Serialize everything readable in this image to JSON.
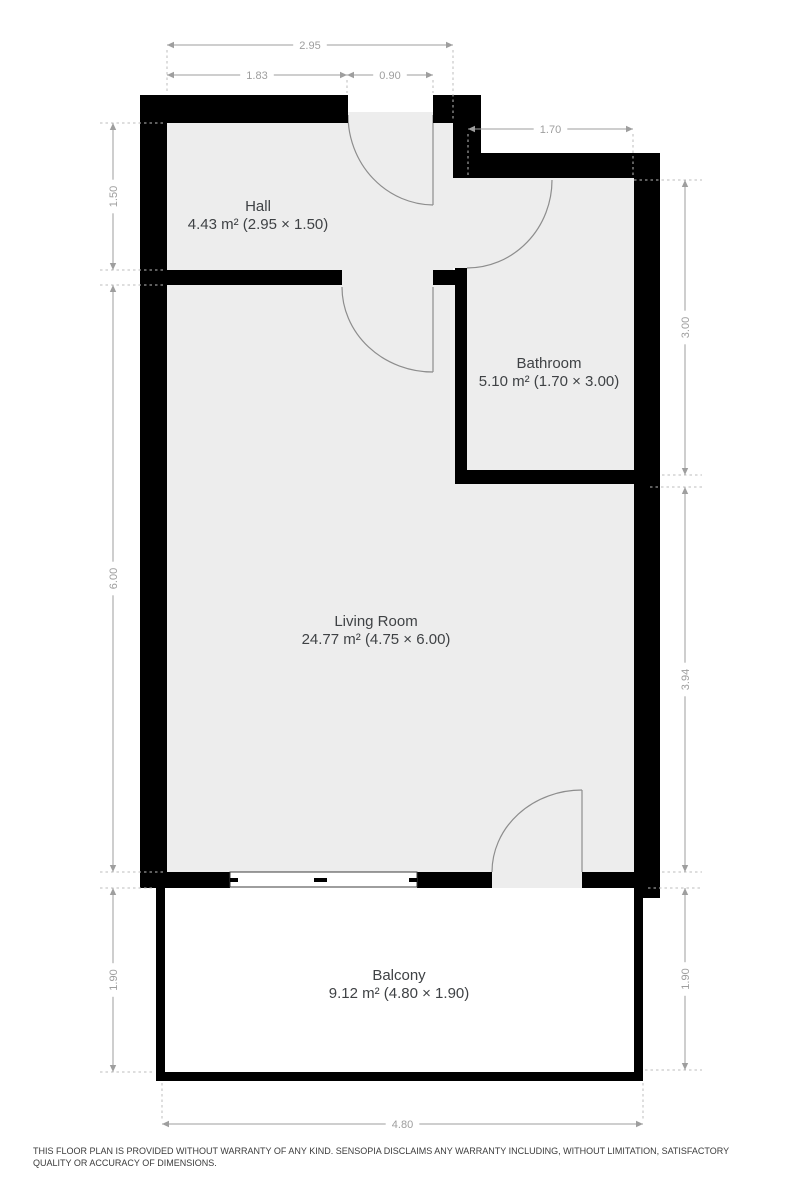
{
  "palette": {
    "wall": "#000000",
    "floor": "#ededed",
    "balcony_floor": "#ffffff",
    "dim": "#9e9e9e",
    "ext": "#bdbdbd",
    "door": "#8d8d8d",
    "window_frame": "#3c3c3c",
    "label": "#3f4245",
    "background": "#ffffff"
  },
  "floorplan": {
    "width": 800,
    "height": 1200,
    "rooms": [
      {
        "name": "Hall",
        "area": "4.43 m² (2.95 × 1.50)",
        "x": 258,
        "y": 211
      },
      {
        "name": "Bathroom",
        "area": "5.10 m² (1.70 × 3.00)",
        "x": 549,
        "y": 368
      },
      {
        "name": "Living Room",
        "area": "24.77 m² (4.75 × 6.00)",
        "x": 376,
        "y": 626
      },
      {
        "name": "Balcony",
        "area": "9.12 m² (4.80 × 1.90)",
        "x": 399,
        "y": 980
      }
    ],
    "floors": [
      {
        "n": "floor-hall",
        "x": 167,
        "y": 123,
        "w": 286,
        "h": 749
      },
      {
        "n": "floor-living-east",
        "x": 453,
        "y": 285,
        "w": 181,
        "h": 587
      },
      {
        "n": "floor-bathroom",
        "x": 467,
        "y": 178,
        "w": 167,
        "h": 292
      },
      {
        "n": "floor-bathroom-doorway",
        "x": 453,
        "y": 178,
        "w": 14,
        "h": 90
      },
      {
        "n": "floor-balcony-doorway",
        "x": 492,
        "y": 872,
        "w": 90,
        "h": 16
      },
      {
        "n": "floor-entry-threshold",
        "x": 348,
        "y": 112,
        "w": 85,
        "h": 11
      },
      {
        "n": "floor-balcony",
        "x": 165,
        "y": 888,
        "w": 469,
        "h": 184,
        "fill": "balcony"
      }
    ],
    "walls": [
      {
        "n": "wall-top-left",
        "x": 140,
        "y": 95,
        "w": 208,
        "h": 28
      },
      {
        "n": "wall-top-right",
        "x": 433,
        "y": 95,
        "w": 48,
        "h": 28
      },
      {
        "n": "wall-left",
        "x": 140,
        "y": 95,
        "w": 27,
        "h": 790
      },
      {
        "n": "wall-entry-step",
        "x": 453,
        "y": 123,
        "w": 28,
        "h": 55
      },
      {
        "n": "wall-bathroom-top",
        "x": 453,
        "y": 153,
        "w": 207,
        "h": 25
      },
      {
        "n": "wall-right",
        "x": 634,
        "y": 153,
        "w": 26,
        "h": 745
      },
      {
        "n": "wall-hall-divider",
        "x": 167,
        "y": 270,
        "w": 175,
        "h": 15
      },
      {
        "n": "wall-divider-stub",
        "x": 433,
        "y": 270,
        "w": 34,
        "h": 15
      },
      {
        "n": "wall-bathroom-left",
        "x": 455,
        "y": 268,
        "w": 12,
        "h": 216
      },
      {
        "n": "wall-bathroom-bottom",
        "x": 455,
        "y": 470,
        "w": 205,
        "h": 14
      },
      {
        "n": "wall-bottom-1",
        "x": 140,
        "y": 872,
        "w": 90,
        "h": 16
      },
      {
        "n": "wall-bottom-2",
        "x": 417,
        "y": 872,
        "w": 75,
        "h": 16
      },
      {
        "n": "wall-bottom-3",
        "x": 582,
        "y": 872,
        "w": 78,
        "h": 16
      },
      {
        "n": "wall-balcony-left",
        "x": 156,
        "y": 885,
        "w": 9,
        "h": 196
      },
      {
        "n": "wall-balcony-bottom",
        "x": 156,
        "y": 1072,
        "w": 487,
        "h": 9
      },
      {
        "n": "wall-balcony-right",
        "x": 634,
        "y": 898,
        "w": 9,
        "h": 183
      }
    ],
    "doors": [
      {
        "n": "door-entrance",
        "leaf": "M433,115 L433,205",
        "arc": "M348,115 A86,90 0 0 0 433,205"
      },
      {
        "n": "door-living",
        "leaf": "M433,287 L433,372",
        "arc": "M342,287 A91,85 0 0 0 433,372"
      },
      {
        "n": "door-bathroom",
        "leaf": "",
        "arc": "M552,180 A85,88 0 0 1 467,268"
      },
      {
        "n": "door-balcony",
        "leaf": "M582,790 L582,872",
        "arc": "M582,790 A90,82 0 0 0 492,872"
      }
    ],
    "window": {
      "x": 230,
      "y": 872,
      "w": 187,
      "h": 15,
      "ticks": [
        [
          230,
          878,
          8,
          4
        ],
        [
          314,
          878,
          13,
          4
        ],
        [
          409,
          878,
          8,
          4
        ]
      ]
    },
    "dimensions": [
      {
        "label": "2.95",
        "y": 45,
        "x1": 167,
        "x2": 453,
        "ext": [
          [
            167,
            50,
            167,
            93
          ],
          [
            453,
            50,
            453,
            121
          ]
        ]
      },
      {
        "label": "1.83",
        "y": 75,
        "x1": 167,
        "x2": 347,
        "ext": [
          [
            347,
            80,
            347,
            93
          ]
        ]
      },
      {
        "label": "0.90",
        "y": 75,
        "x1": 347,
        "x2": 433,
        "ext": [
          [
            433,
            80,
            433,
            93
          ]
        ]
      },
      {
        "label": "1.70",
        "y": 129,
        "x1": 468,
        "x2": 633,
        "ext": [
          [
            468,
            134,
            468,
            176
          ],
          [
            633,
            134,
            633,
            178
          ]
        ]
      },
      {
        "label": "1.50",
        "x": 113,
        "y1": 123,
        "y2": 270,
        "ext": [
          [
            100,
            123,
            164,
            123
          ],
          [
            100,
            270,
            164,
            270
          ]
        ]
      },
      {
        "label": "6.00",
        "x": 113,
        "y1": 285,
        "y2": 872,
        "ext": [
          [
            100,
            285,
            164,
            285
          ],
          [
            100,
            872,
            164,
            872
          ]
        ]
      },
      {
        "label": "1.90",
        "x": 113,
        "y1": 888,
        "y2": 1072,
        "ext": [
          [
            100,
            888,
            154,
            888
          ],
          [
            100,
            1072,
            154,
            1072
          ]
        ]
      },
      {
        "label": "3.00",
        "x": 685,
        "y1": 180,
        "y2": 475,
        "ext": [
          [
            634,
            180,
            702,
            180
          ],
          [
            662,
            475,
            702,
            475
          ]
        ]
      },
      {
        "label": "3.94",
        "x": 685,
        "y1": 487,
        "y2": 872,
        "ext": [
          [
            650,
            487,
            702,
            487
          ],
          [
            662,
            872,
            702,
            872
          ]
        ]
      },
      {
        "label": "1.90",
        "x": 685,
        "y1": 888,
        "y2": 1070,
        "ext": [
          [
            648,
            888,
            702,
            888
          ],
          [
            645,
            1070,
            702,
            1070
          ]
        ]
      },
      {
        "label": "4.80",
        "y": 1124,
        "x1": 162,
        "x2": 643,
        "ext": [
          [
            162,
            1083,
            162,
            1119
          ],
          [
            643,
            1083,
            643,
            1119
          ]
        ]
      }
    ]
  },
  "footer": {
    "disclaimer": "THIS FLOOR PLAN IS PROVIDED WITHOUT WARRANTY OF ANY KIND. SENSOPIA DISCLAIMS ANY WARRANTY INCLUDING, WITHOUT LIMITATION, SATISFACTORY QUALITY OR ACCURACY OF DIMENSIONS."
  }
}
